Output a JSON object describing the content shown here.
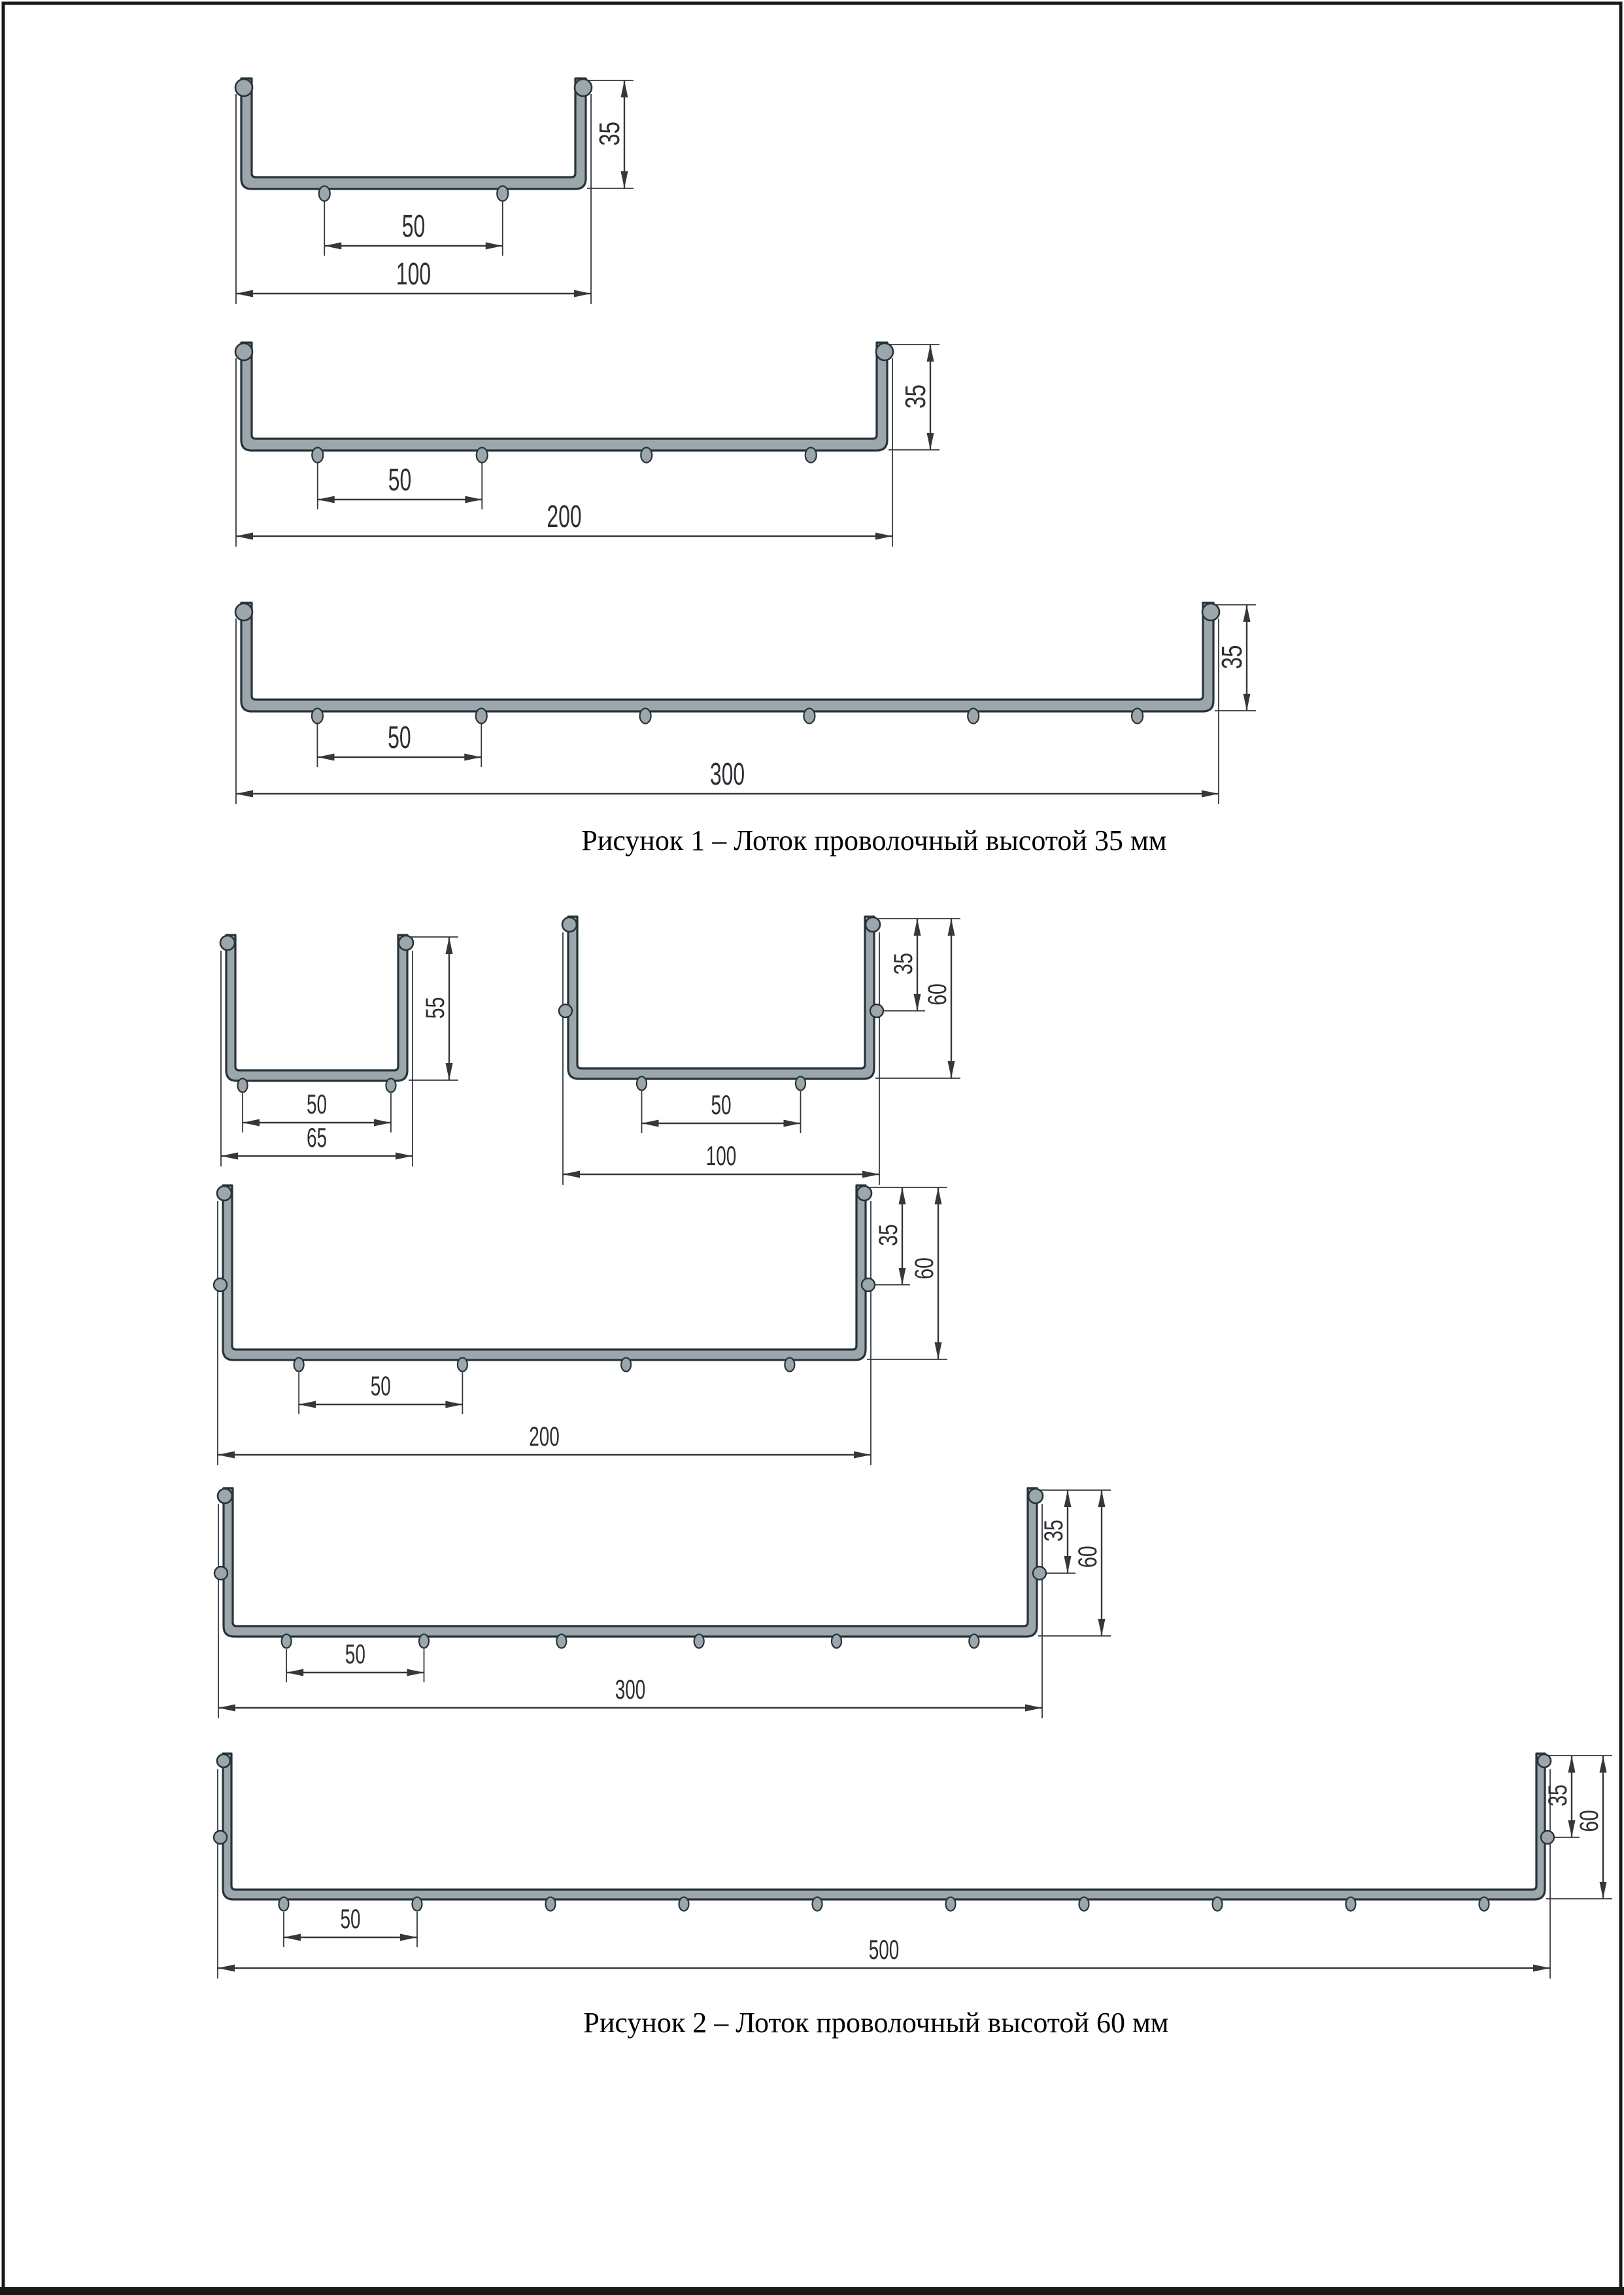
{
  "figure1": {
    "caption": "Рисунок 1 – Лоток проволочный высотой 35 мм",
    "height_mm": 35,
    "trays": [
      {
        "width_label": "100",
        "height_label": "35",
        "pitch_label": "50",
        "width_mm": 100,
        "height_mm": 35,
        "wire_pitch_mm": 50,
        "bottom_wires": 2,
        "side_mid_wire": false
      },
      {
        "width_label": "200",
        "height_label": "35",
        "pitch_label": "50",
        "width_mm": 200,
        "height_mm": 35,
        "wire_pitch_mm": 50,
        "bottom_wires": 4,
        "side_mid_wire": false
      },
      {
        "width_label": "300",
        "height_label": "35",
        "pitch_label": "50",
        "width_mm": 300,
        "height_mm": 35,
        "wire_pitch_mm": 50,
        "bottom_wires": 6,
        "side_mid_wire": false
      }
    ]
  },
  "figure2": {
    "caption": "Рисунок 2 – Лоток проволочный высотой 60 мм",
    "height_mm": 60,
    "trays": [
      {
        "width_label": "65",
        "height_label": "55",
        "pitch_label": "50",
        "width_mm": 65,
        "height_mm": 55,
        "wire_pitch_mm": 50,
        "bottom_wires": 2,
        "side_mid_wire": false
      },
      {
        "width_label": "100",
        "height_label": "60",
        "mid_height_label": "35",
        "pitch_label": "50",
        "width_mm": 100,
        "height_mm": 60,
        "wire_pitch_mm": 50,
        "bottom_wires": 2,
        "side_mid_wire": true
      },
      {
        "width_label": "200",
        "height_label": "60",
        "mid_height_label": "35",
        "pitch_label": "50",
        "width_mm": 200,
        "height_mm": 60,
        "wire_pitch_mm": 50,
        "bottom_wires": 4,
        "side_mid_wire": true
      },
      {
        "width_label": "300",
        "height_label": "60",
        "mid_height_label": "35",
        "pitch_label": "50",
        "width_mm": 300,
        "height_mm": 60,
        "wire_pitch_mm": 50,
        "bottom_wires": 6,
        "side_mid_wire": true
      },
      {
        "width_label": "500",
        "height_label": "60",
        "mid_height_label": "35",
        "pitch_label": "50",
        "width_mm": 500,
        "height_mm": 60,
        "wire_pitch_mm": 50,
        "bottom_wires": 10,
        "side_mid_wire": true
      }
    ]
  },
  "colors": {
    "tray_fill": "#9ca7ab",
    "tray_outline": "#27333a",
    "dimension_line": "#33383c",
    "text": "#2b2f33",
    "caption": "#000000",
    "page_border": "#1a1a1a"
  }
}
